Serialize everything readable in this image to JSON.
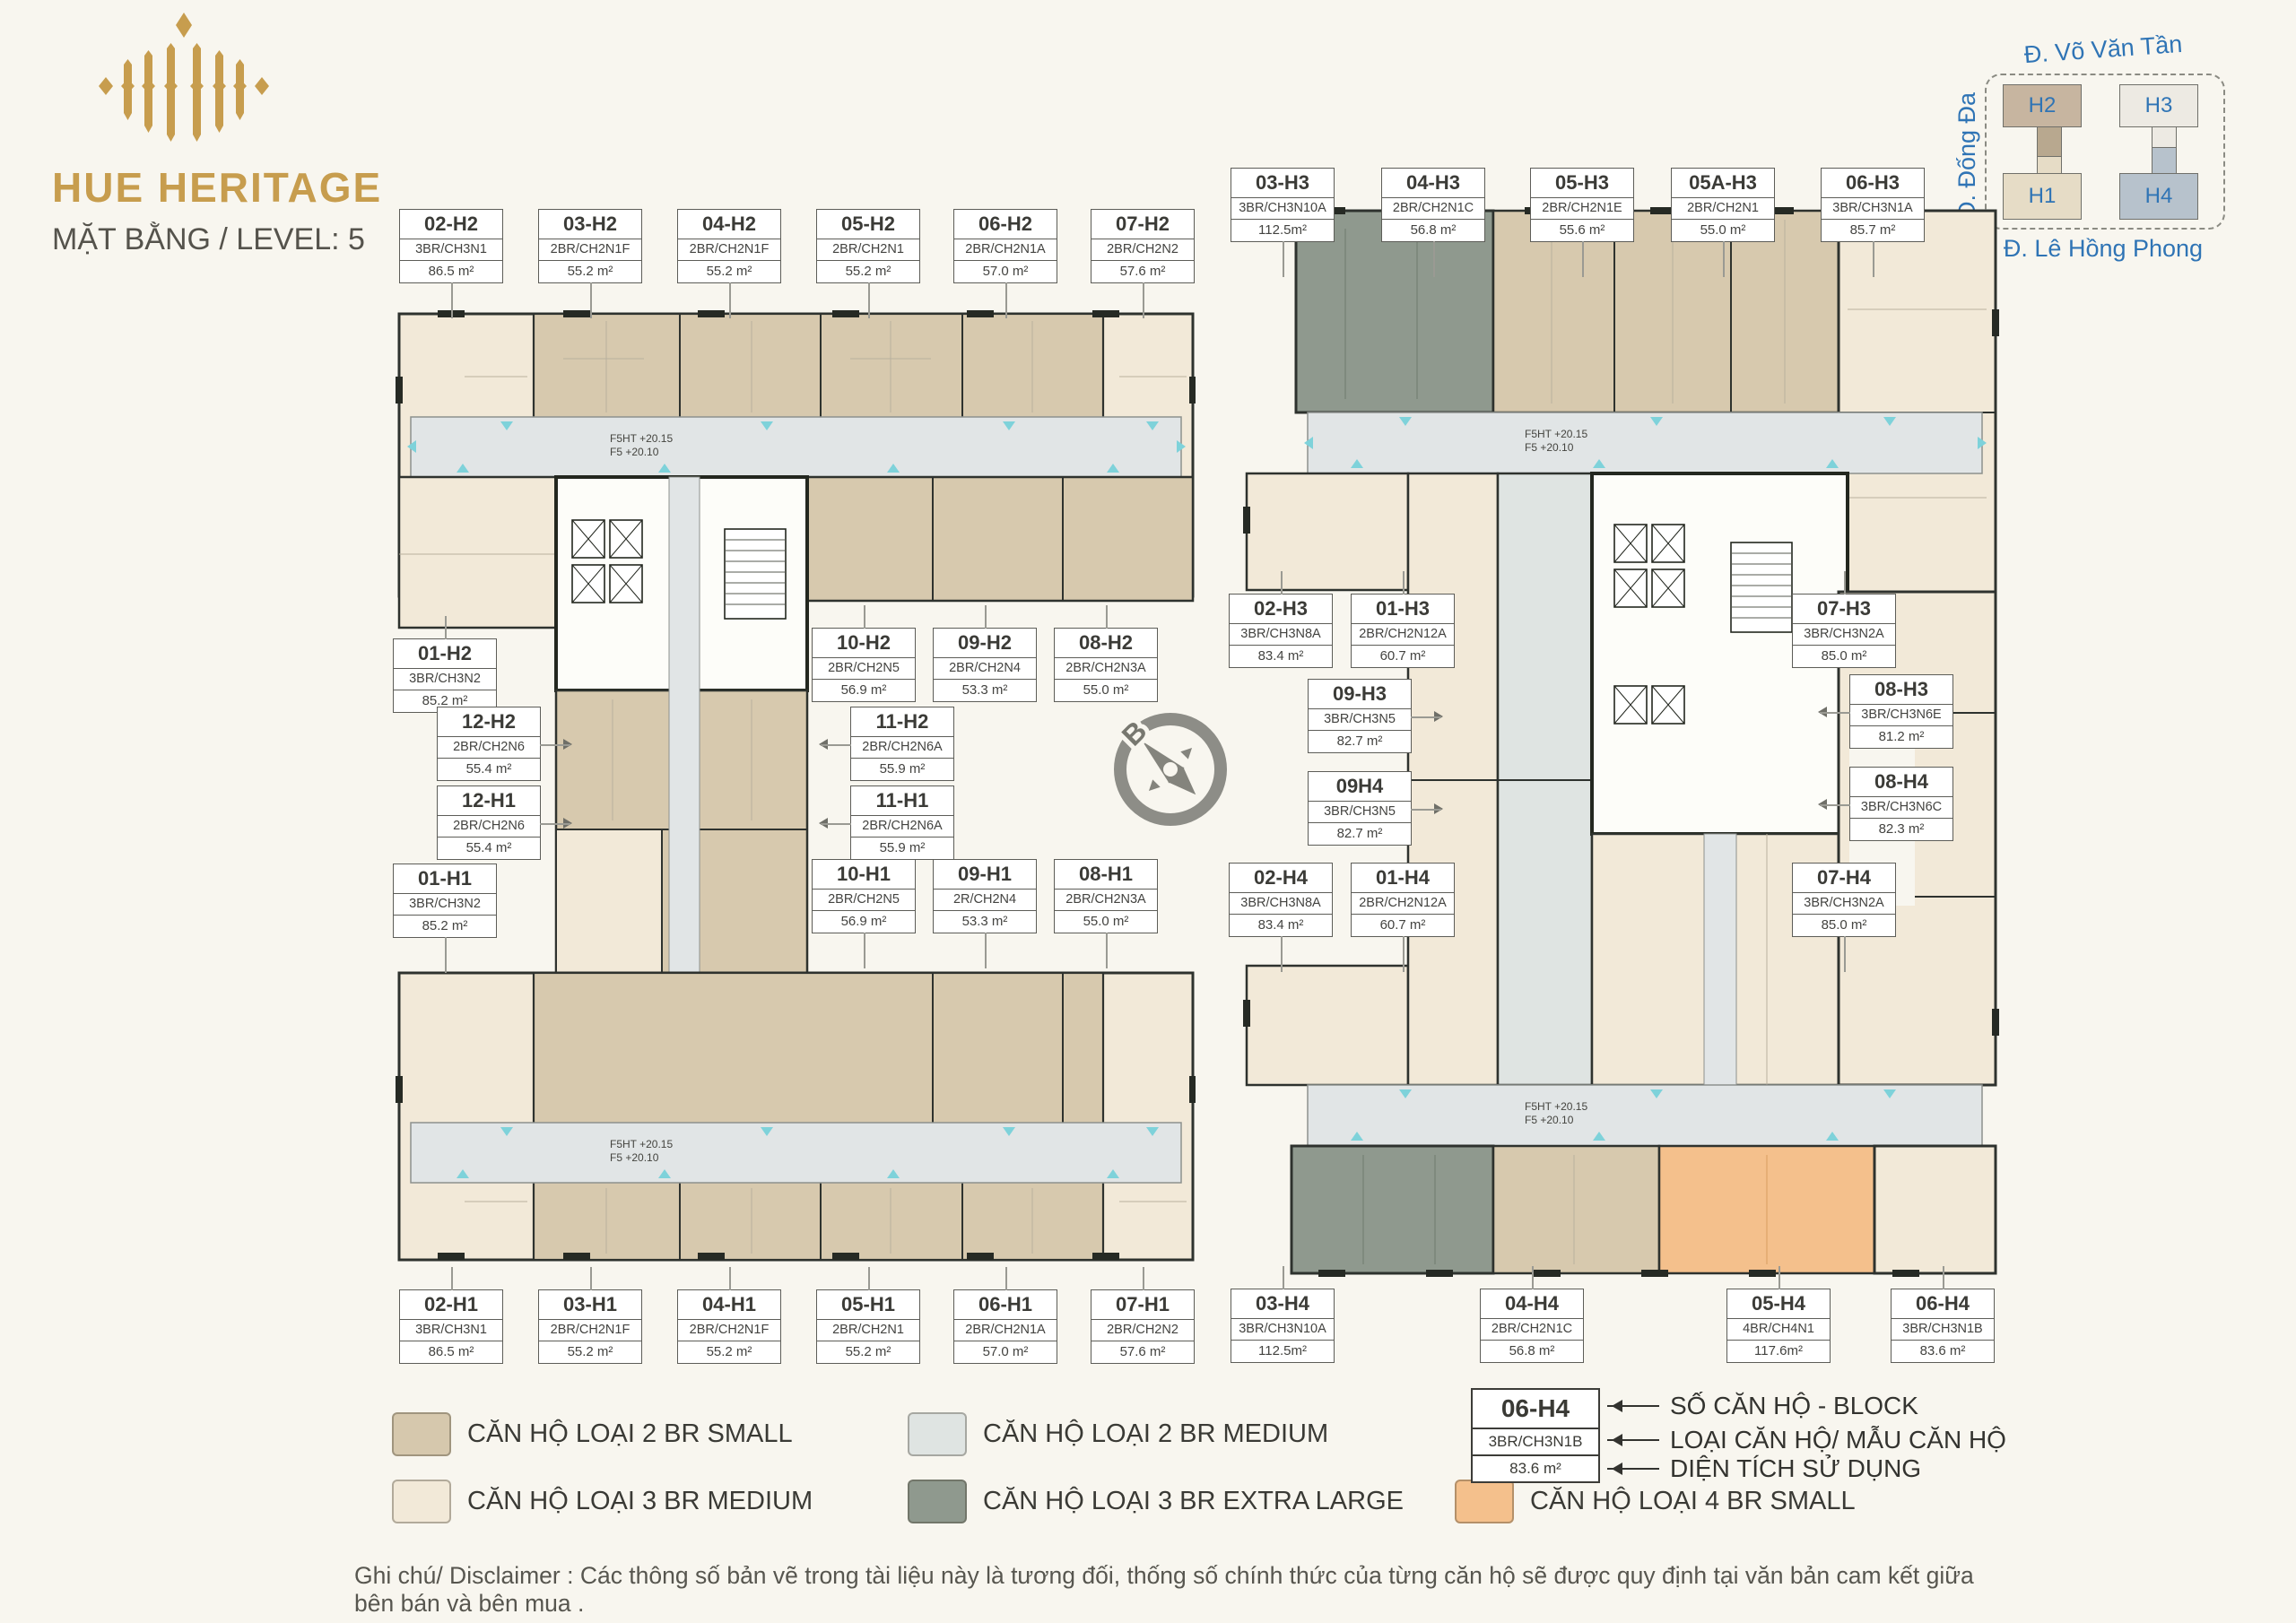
{
  "branding": {
    "title": "HUE HERITAGE",
    "subtitle": "MẶT BẰNG / LEVEL: 5"
  },
  "site_map": {
    "streets": {
      "top": "Đ. Võ Văn Tần",
      "left": "Đ. Đống Đa",
      "bottom": "Đ. Lê Hồng Phong"
    },
    "blocks": [
      {
        "label": "H2",
        "color": "#c7b5a0"
      },
      {
        "label": "H3",
        "color": "#edeae3"
      },
      {
        "label": "H1",
        "color": "#e6dcc6"
      },
      {
        "label": "H4",
        "color": "#b7c2cc"
      }
    ]
  },
  "compass": {
    "north_label": "B"
  },
  "corridor_note": {
    "line1": "F5HT +20.15",
    "line2": "F5 +20.10"
  },
  "units": [
    {
      "id": "02-H2",
      "type": "3BR/CH3N1",
      "area": "86.5 m²"
    },
    {
      "id": "03-H2",
      "type": "2BR/CH2N1F",
      "area": "55.2 m²"
    },
    {
      "id": "04-H2",
      "type": "2BR/CH2N1F",
      "area": "55.2 m²"
    },
    {
      "id": "05-H2",
      "type": "2BR/CH2N1",
      "area": "55.2 m²"
    },
    {
      "id": "06-H2",
      "type": "2BR/CH2N1A",
      "area": "57.0 m²"
    },
    {
      "id": "07-H2",
      "type": "2BR/CH2N2",
      "area": "57.6 m²"
    },
    {
      "id": "01-H2",
      "type": "3BR/CH3N2",
      "area": "85.2 m²"
    },
    {
      "id": "10-H2",
      "type": "2BR/CH2N5",
      "area": "56.9 m²"
    },
    {
      "id": "09-H2",
      "type": "2BR/CH2N4",
      "area": "53.3 m²"
    },
    {
      "id": "08-H2",
      "type": "2BR/CH2N3A",
      "area": "55.0 m²"
    },
    {
      "id": "12-H2",
      "type": "2BR/CH2N6",
      "area": "55.4 m²"
    },
    {
      "id": "11-H2",
      "type": "2BR/CH2N6A",
      "area": "55.9 m²"
    },
    {
      "id": "12-H1",
      "type": "2BR/CH2N6",
      "area": "55.4 m²"
    },
    {
      "id": "11-H1",
      "type": "2BR/CH2N6A",
      "area": "55.9 m²"
    },
    {
      "id": "01-H1",
      "type": "3BR/CH3N2",
      "area": "85.2 m²"
    },
    {
      "id": "10-H1",
      "type": "2BR/CH2N5",
      "area": "56.9 m²"
    },
    {
      "id": "09-H1",
      "type": "2R/CH2N4",
      "area": "53.3 m²"
    },
    {
      "id": "08-H1",
      "type": "2BR/CH2N3A",
      "area": "55.0 m²"
    },
    {
      "id": "02-H1",
      "type": "3BR/CH3N1",
      "area": "86.5 m²"
    },
    {
      "id": "03-H1",
      "type": "2BR/CH2N1F",
      "area": "55.2 m²"
    },
    {
      "id": "04-H1",
      "type": "2BR/CH2N1F",
      "area": "55.2 m²"
    },
    {
      "id": "05-H1",
      "type": "2BR/CH2N1",
      "area": "55.2 m²"
    },
    {
      "id": "06-H1",
      "type": "2BR/CH2N1A",
      "area": "57.0 m²"
    },
    {
      "id": "07-H1",
      "type": "2BR/CH2N2",
      "area": "57.6 m²"
    },
    {
      "id": "03-H3",
      "type": "3BR/CH3N10A",
      "area": "112.5m²"
    },
    {
      "id": "04-H3",
      "type": "2BR/CH2N1C",
      "area": "56.8 m²"
    },
    {
      "id": "05-H3",
      "type": "2BR/CH2N1E",
      "area": "55.6 m²"
    },
    {
      "id": "05A-H3",
      "type": "2BR/CH2N1",
      "area": "55.0 m²"
    },
    {
      "id": "06-H3",
      "type": "3BR/CH3N1A",
      "area": "85.7 m²"
    },
    {
      "id": "02-H3",
      "type": "3BR/CH3N8A",
      "area": "83.4 m²"
    },
    {
      "id": "01-H3",
      "type": "2BR/CH2N12A",
      "area": "60.7 m²"
    },
    {
      "id": "07-H3",
      "type": "3BR/CH3N2A",
      "area": "85.0 m²"
    },
    {
      "id": "09-H3",
      "type": "3BR/CH3N5",
      "area": "82.7 m²"
    },
    {
      "id": "08-H3",
      "type": "3BR/CH3N6E",
      "area": "81.2 m²"
    },
    {
      "id": "09H4",
      "type": "3BR/CH3N5",
      "area": "82.7 m²"
    },
    {
      "id": "08-H4",
      "type": "3BR/CH3N6C",
      "area": "82.3 m²"
    },
    {
      "id": "02-H4",
      "type": "3BR/CH3N8A",
      "area": "83.4 m²"
    },
    {
      "id": "01-H4",
      "type": "2BR/CH2N12A",
      "area": "60.7 m²"
    },
    {
      "id": "07-H4",
      "type": "3BR/CH3N2A",
      "area": "85.0 m²"
    },
    {
      "id": "03-H4",
      "type": "3BR/CH3N10A",
      "area": "112.5m²"
    },
    {
      "id": "04-H4",
      "type": "2BR/CH2N1C",
      "area": "56.8 m²"
    },
    {
      "id": "05-H4",
      "type": "4BR/CH4N1",
      "area": "117.6m²"
    },
    {
      "id": "06-H4",
      "type": "3BR/CH3N1B",
      "area": "83.6 m²"
    }
  ],
  "legend": {
    "items": [
      {
        "label": "CĂN HỘ LOẠI 2 BR SMALL",
        "color": "#d6c8ad"
      },
      {
        "label": "CĂN HỘ LOẠI 2 BR MEDIUM",
        "color": "#dfe4e2"
      },
      {
        "label": "CĂN HỘ LOẠI 3 BR MEDIUM",
        "color": "#f2e9d8"
      },
      {
        "label": "CĂN HỘ LOẠI 3 BR EXTRA LARGE",
        "color": "#8f998e"
      },
      {
        "label": "CĂN HỘ LOẠI 4 BR SMALL",
        "color": "#f4c08c"
      }
    ]
  },
  "key": {
    "id": "06-H4",
    "type": "3BR/CH3N1B",
    "area": "83.6 m²",
    "labels": [
      "SỐ CĂN HỘ - BLOCK",
      "LOẠI CĂN HỘ/ MẪU CĂN HỘ",
      "DIỆN TÍCH SỬ DỤNG"
    ]
  },
  "disclaimer": "Ghi chú/ Disclaimer : Các thông số bản vẽ trong tài liệu này là tương đối, thống số chính thức của từng căn hộ sẽ được quy định tại văn bản cam kết giữa bên bán và bên mua ."
}
